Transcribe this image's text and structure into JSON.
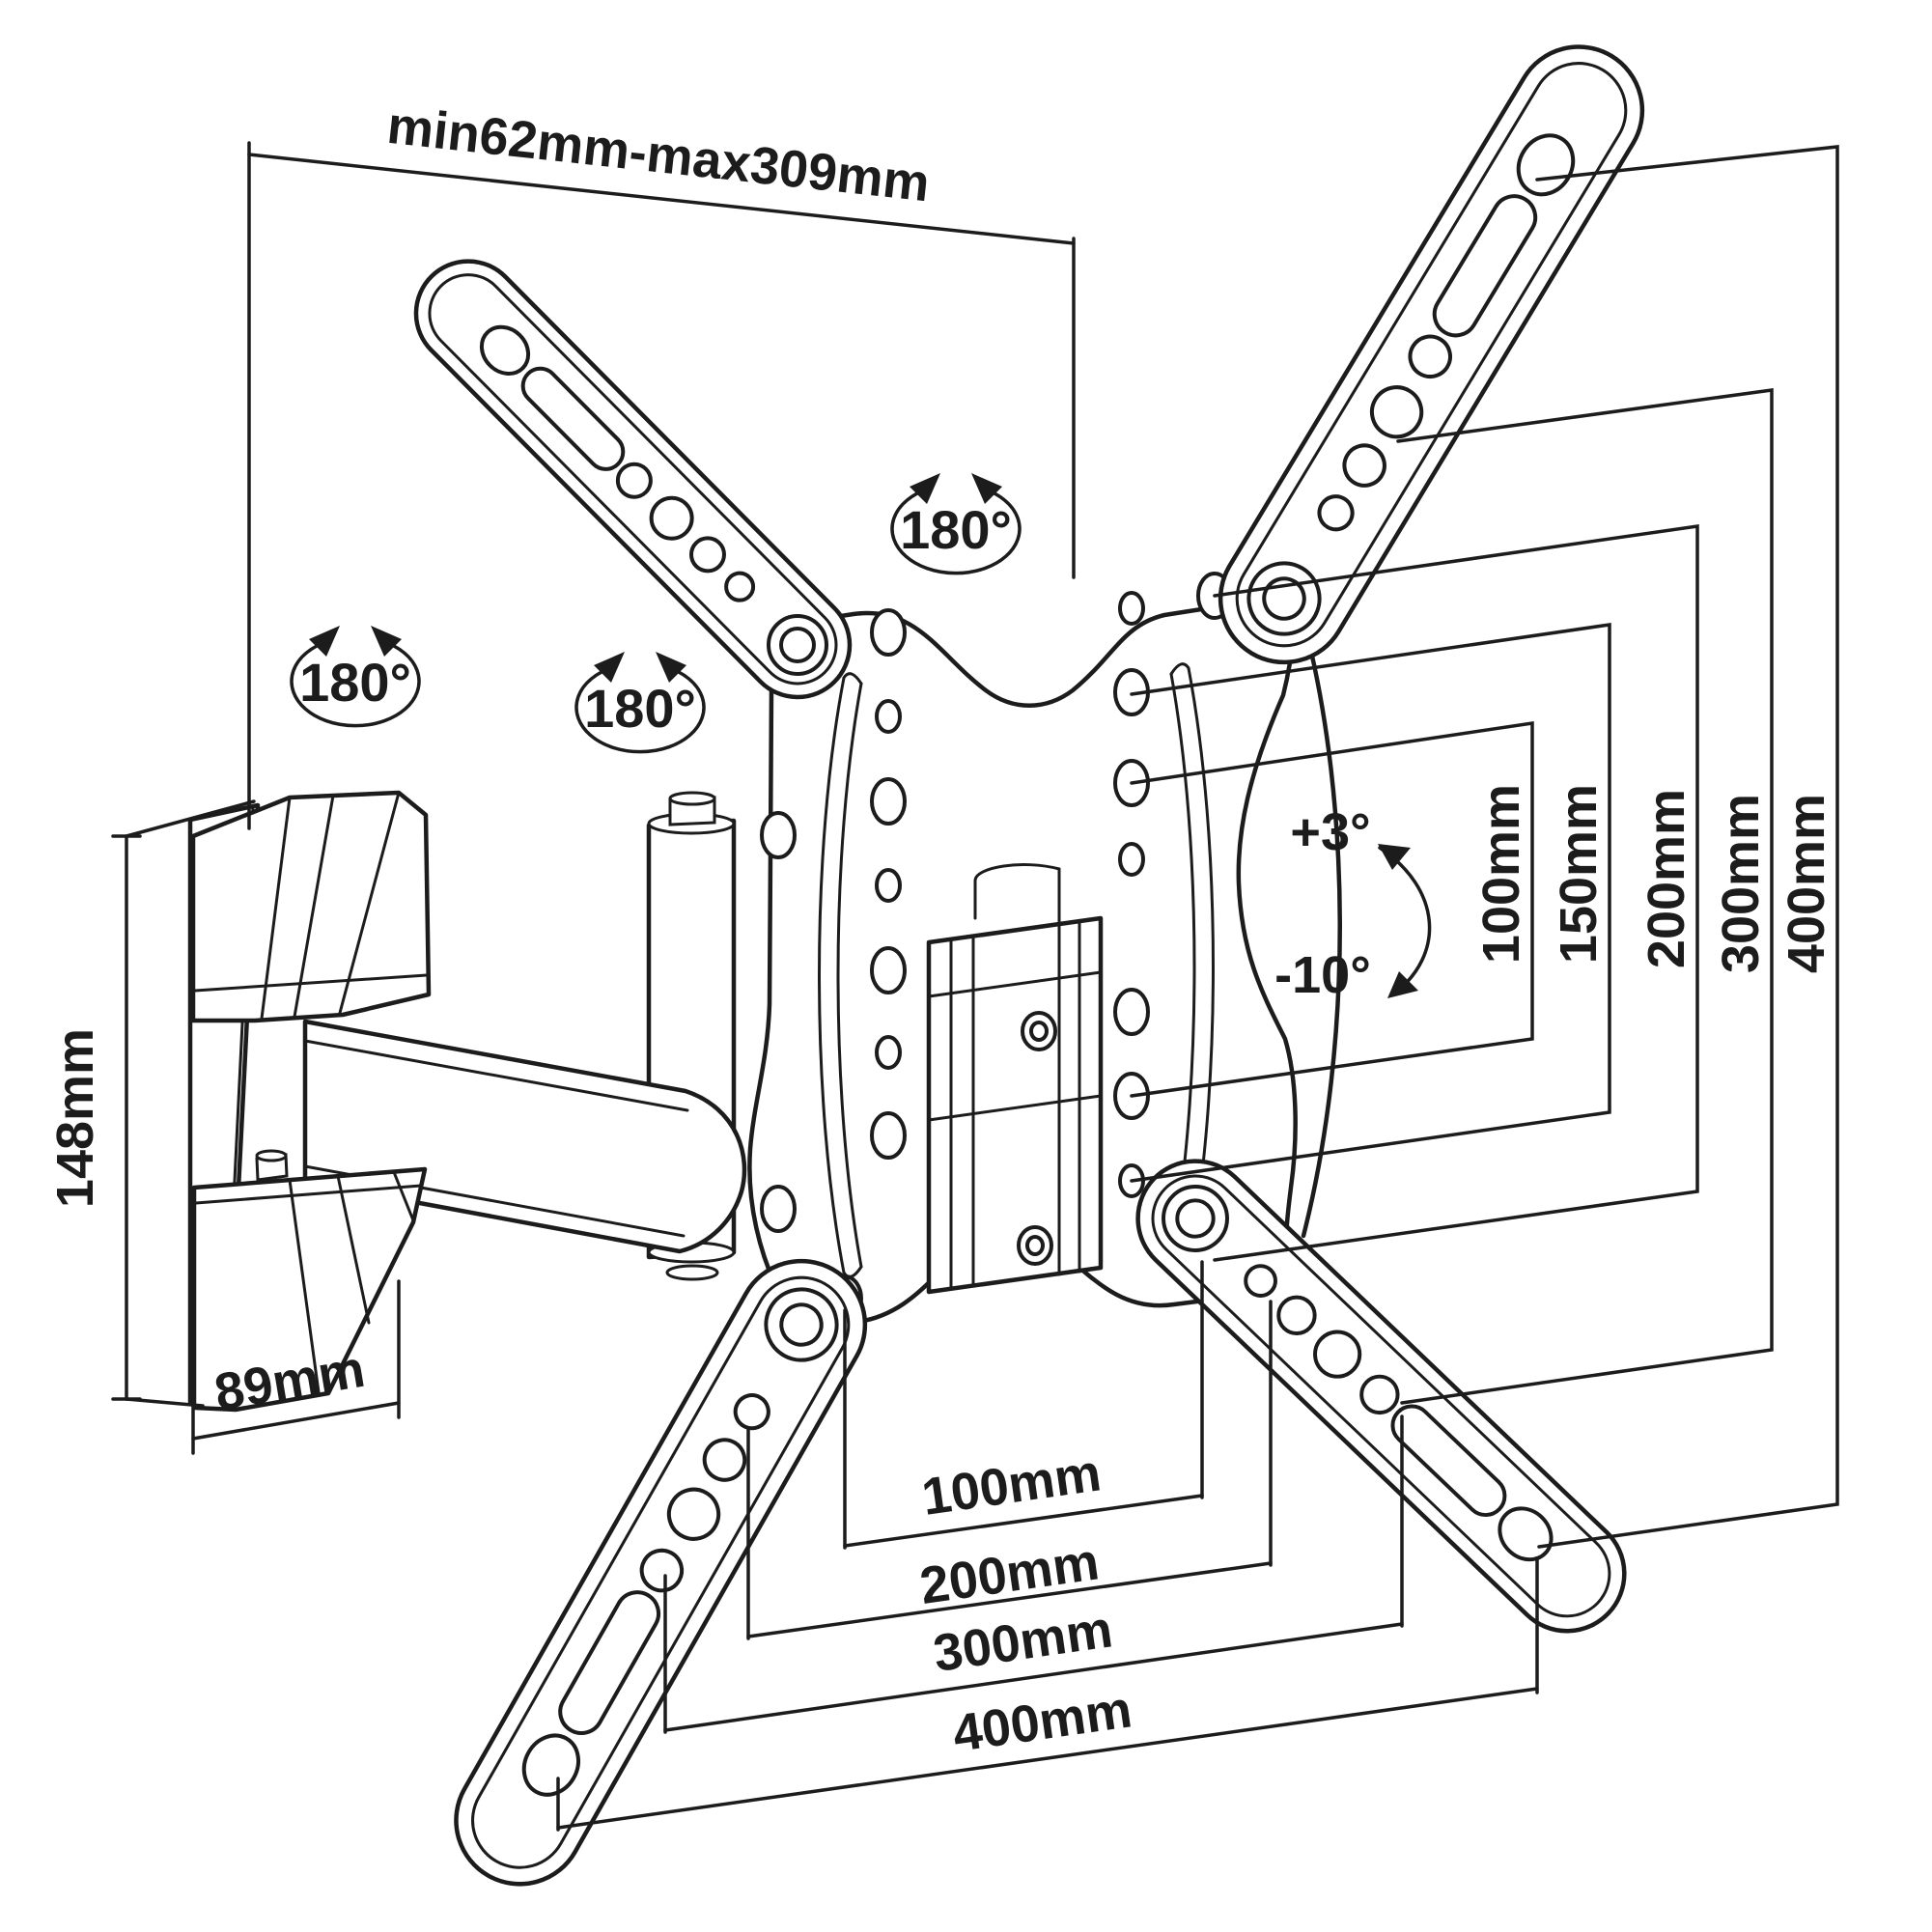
{
  "labels": {
    "arm_extension_range": "min62mm-max309mm",
    "rotation_badges": [
      "180°",
      "180°",
      "180°"
    ],
    "bracket_height": "148mm",
    "bracket_depth": "89mm",
    "tilt_up": "+3°",
    "tilt_down": "-10°",
    "vesa_vertical": [
      "100mm",
      "150mm",
      "200mm",
      "300mm",
      "400mm"
    ],
    "vesa_horizontal": [
      "100mm",
      "200mm",
      "300mm",
      "400mm"
    ]
  },
  "colors": {
    "line": "#1c1c1c",
    "background": "#ffffff"
  }
}
